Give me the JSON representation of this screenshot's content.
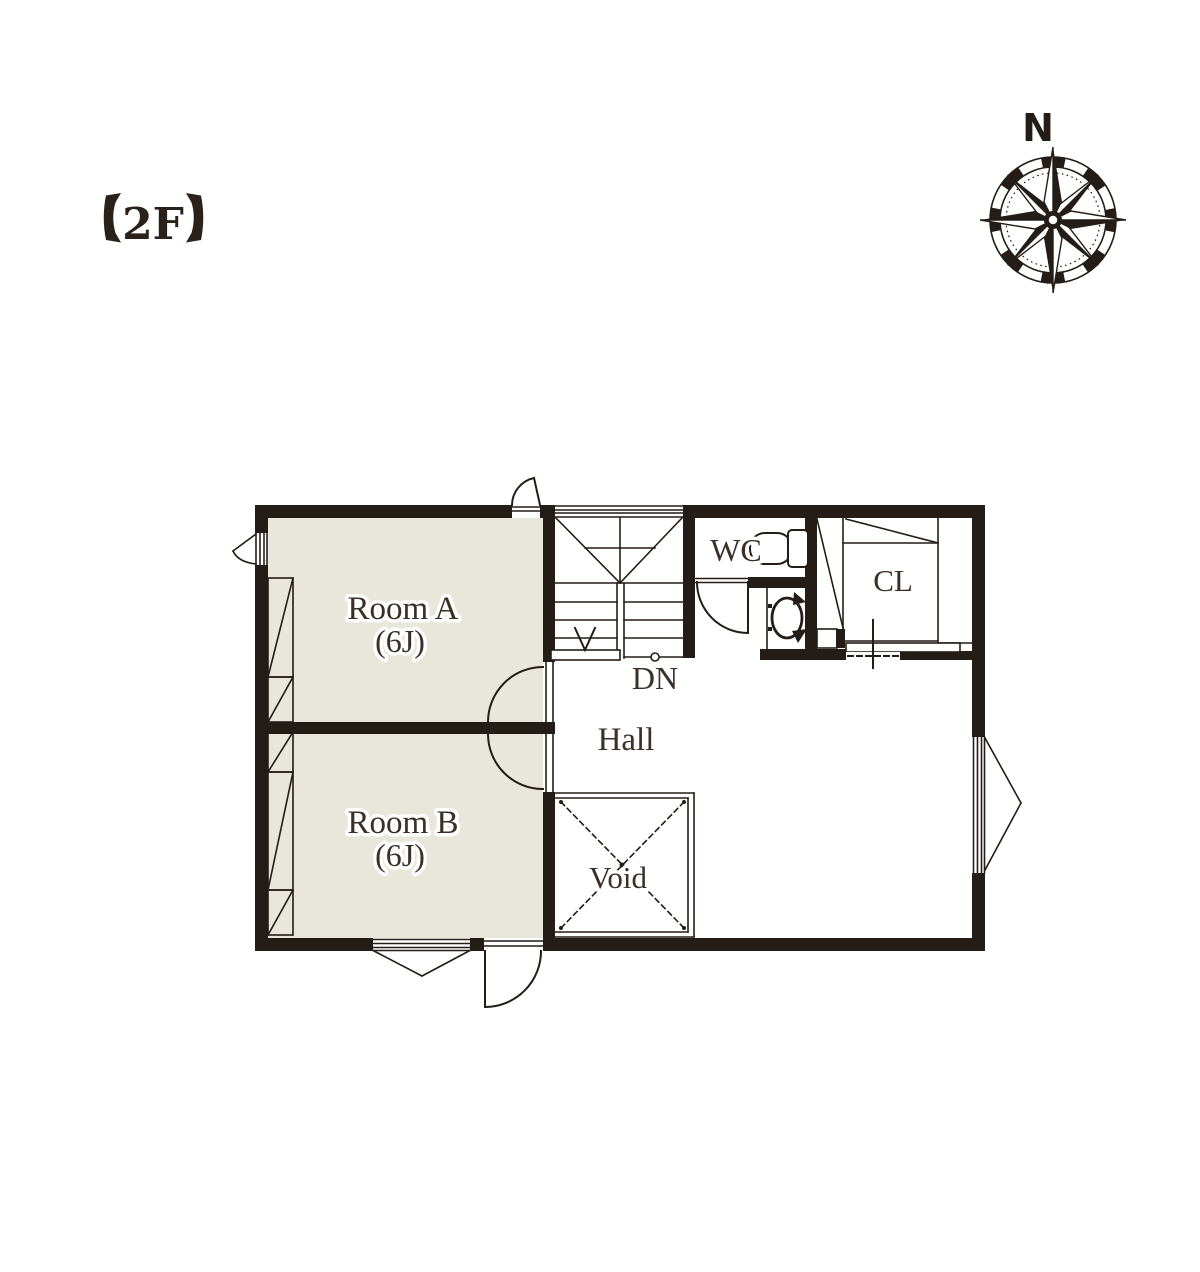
{
  "header": {
    "label": "【2F】",
    "floor": "2F"
  },
  "compass": {
    "north": "N"
  },
  "rooms": {
    "room_a": {
      "name": "Room A",
      "size": "(6J)"
    },
    "room_b": {
      "name": "Room B",
      "size": "(6J)"
    },
    "hall": {
      "name": "Hall"
    },
    "wc": {
      "name": "WC"
    },
    "closet": {
      "name": "CL"
    },
    "void": {
      "name": "Void"
    }
  },
  "stairs": {
    "direction": "DN"
  },
  "colors": {
    "wall": "#241c16",
    "room_fill": "#e9e6db",
    "label_text": "#3a3027",
    "background": "#ffffff"
  }
}
